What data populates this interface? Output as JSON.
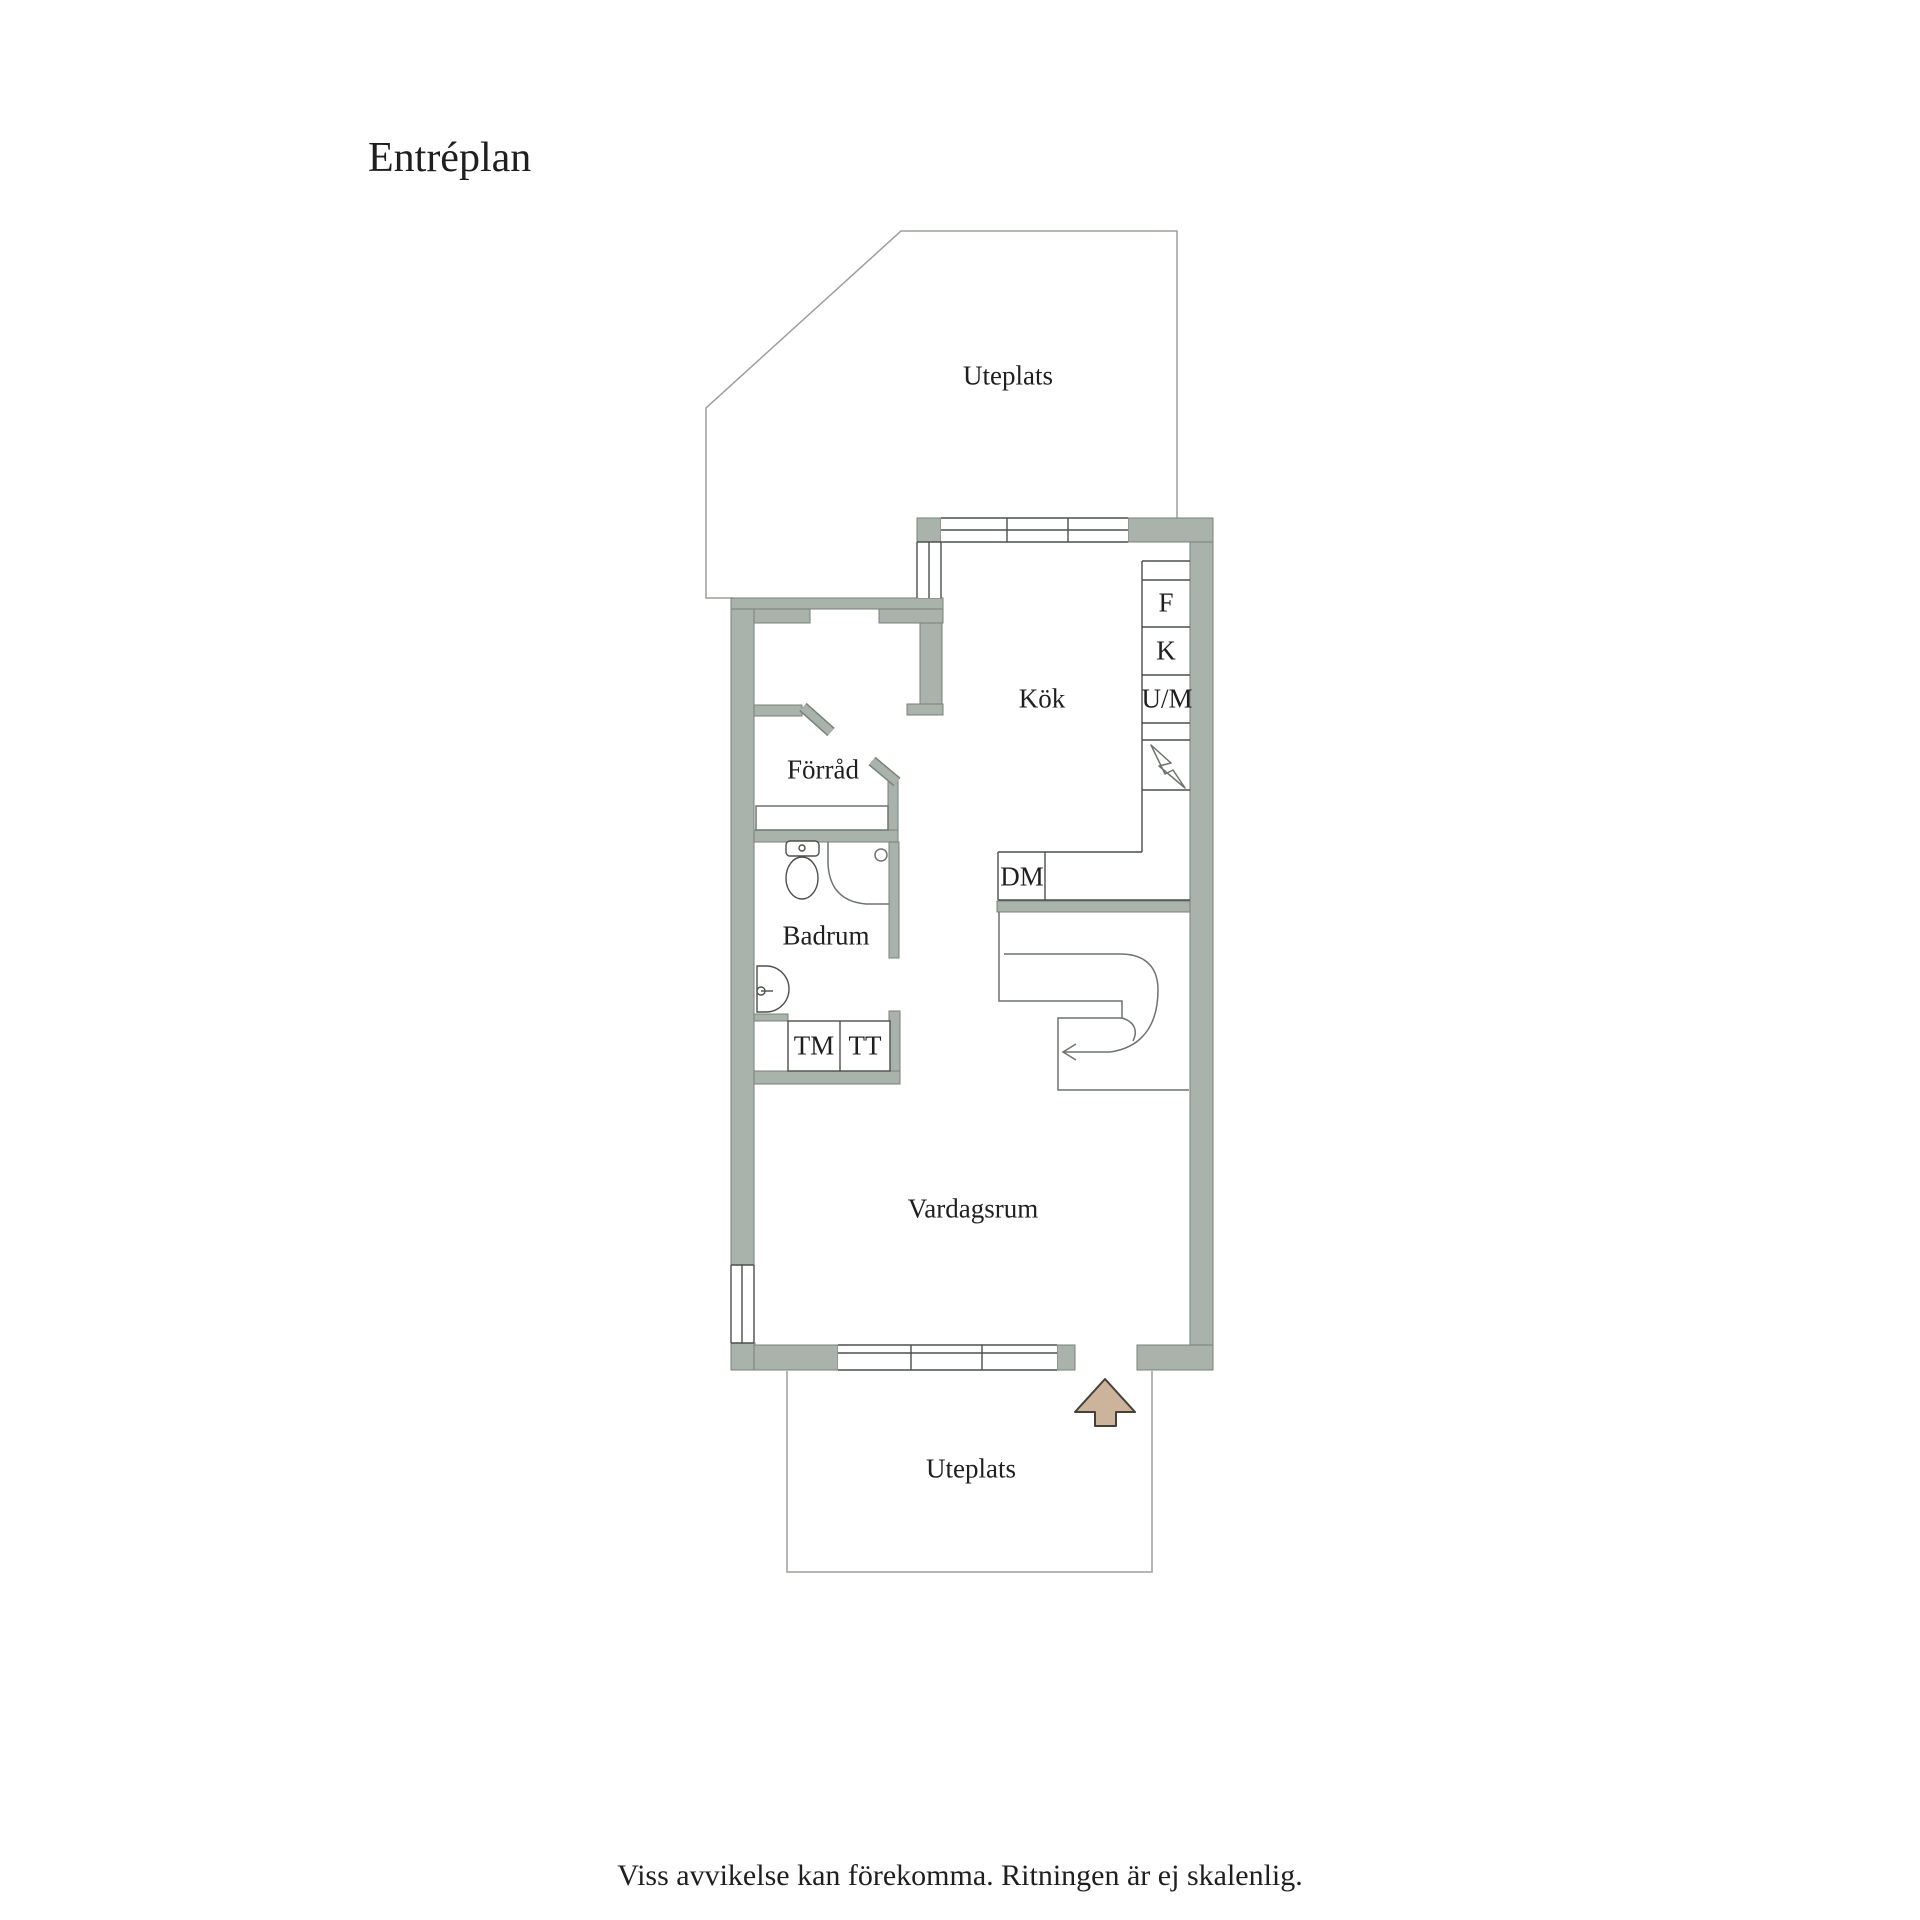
{
  "plan": {
    "title": "Entréplan",
    "rooms": {
      "uteplats_top": "Uteplats",
      "kok": "Kök",
      "forrad": "Förråd",
      "badrum": "Badrum",
      "vardagsrum": "Vardagsrum",
      "uteplats_bottom": "Uteplats"
    },
    "appliance_labels": {
      "f": "F",
      "k": "K",
      "um": "U/M",
      "dm": "DM",
      "tm": "TM",
      "tt": "TT"
    },
    "disclaimer": "Viss avvikelse kan förekomma. Ritningen är ej skalenlig."
  },
  "symbols": {
    "entry_arrow": "entry-direction-arrow",
    "stairs_arrow": "stairs-walk-line-arrow",
    "electrical": "lightning-bolt"
  },
  "colors": {
    "background": "#ffffff",
    "text": "#1f1f1f",
    "wall": "#a9b2ab",
    "wall_edge": "#79817a",
    "line_light": "#9aa09a",
    "line_mid": "#6e746e",
    "line_dark": "#4b504b",
    "arrow_fill": "#ccb39b",
    "arrow_outline": "#45403a"
  }
}
